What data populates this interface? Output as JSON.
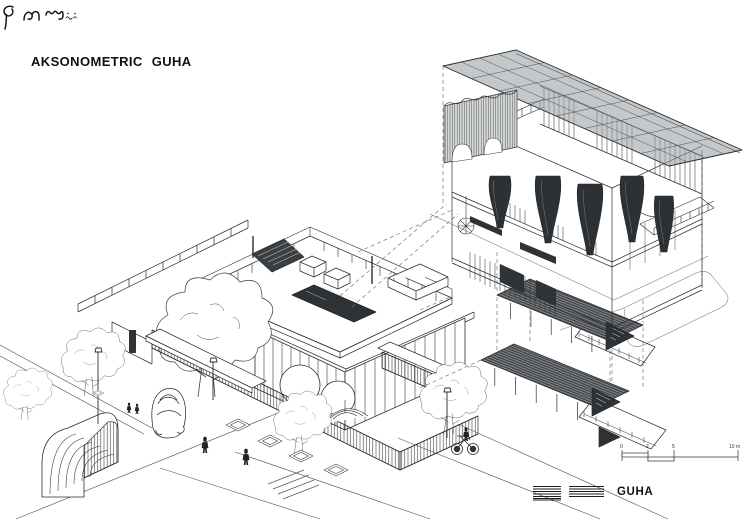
{
  "title": "AKSONOMETRIC GUHA",
  "drawing": {
    "style": "black ink axonometric architectural drawing on white",
    "ink_color": "#2b2b2b",
    "canopy_gray": "#9aa0a5",
    "left_subject": "residential compound: rooftop-terrace house, glass lower floor, trees, corrugated fence, quonset hut, car, pedestrians, street",
    "right_subject": "exploded axonometric of GUHA building: gridded canopy roof, sectioned wall, cave-like columns, two pergola floor levels, bicycle"
  },
  "scale_bar": {
    "labels": [
      "0",
      "2",
      "5",
      "10 m"
    ]
  },
  "footer": {
    "credits_note": "two blocks of fine print (illegible at this scale)",
    "brand": "GUHA",
    "logo": "hanacaraka-script-wordmark"
  }
}
